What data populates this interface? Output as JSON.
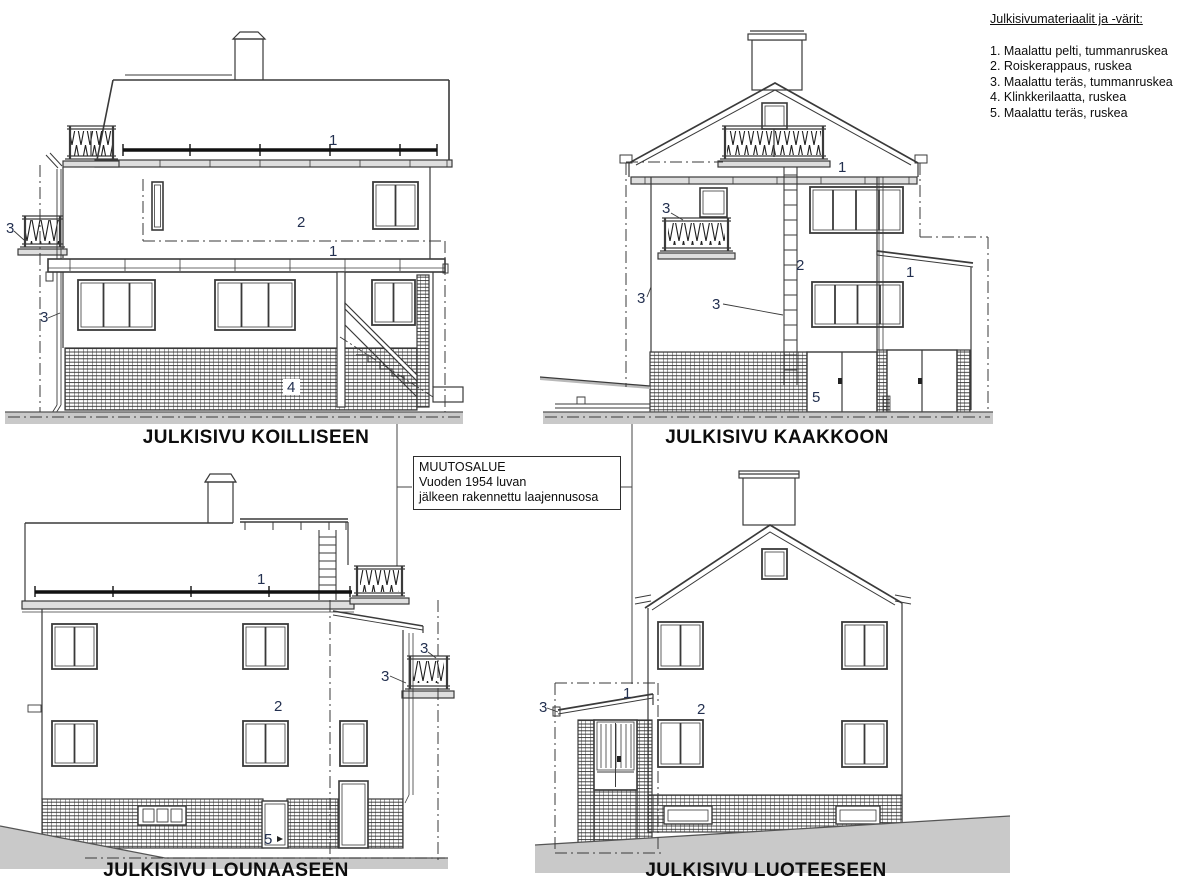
{
  "drawing": {
    "legend": {
      "title": "Julkisivumateriaalit ja -värit:",
      "items": [
        "1. Maalattu pelti, tummanruskea",
        "2. Roiskerappaus, ruskea",
        "3. Maalattu teräs, tummanruskea",
        "4. Klinkkerilaatta, ruskea",
        "5. Maalattu teräs, ruskea"
      ]
    },
    "annotation_box": {
      "lines": [
        "MUUTOSALUE",
        "Vuoden 1954 luvan",
        "jälkeen rakennettu laajennusosa"
      ]
    },
    "elevations": {
      "koilliseen": {
        "title": "JULKISIVU KOILLISEEN",
        "callouts": {
          "snow_guard": "1",
          "render_wall": "2",
          "canopy": "1",
          "balcony_rail": "3",
          "downpipe": "3",
          "clinker_base": "4"
        }
      },
      "kaakkoon": {
        "title": "JULKISIVU KAAKKOON",
        "callouts": {
          "eave_guard": "1",
          "render_wall": "2",
          "balcony_rail": "3",
          "downpipe": "3",
          "roof_ladder": "3",
          "garage_door": "5",
          "ext_roof": "1"
        }
      },
      "lounaaseen": {
        "title": "JULKISIVU LOUNAASEEN",
        "callouts": {
          "snow_guard": "1",
          "render_wall": "2",
          "balcony_rail_upper": "3",
          "balcony_rail_lower": "3",
          "cellar_door": "5"
        }
      },
      "luoteeseen": {
        "title": "JULKISIVU LUOTEESEEN",
        "callouts": {
          "porch_steel": "3",
          "porch_roof": "1",
          "render_wall": "2"
        }
      }
    },
    "colors": {
      "line": "#3a3a3a",
      "ground": "#c9c9c9",
      "fascia": "#dedede",
      "callout": "#233050"
    }
  }
}
